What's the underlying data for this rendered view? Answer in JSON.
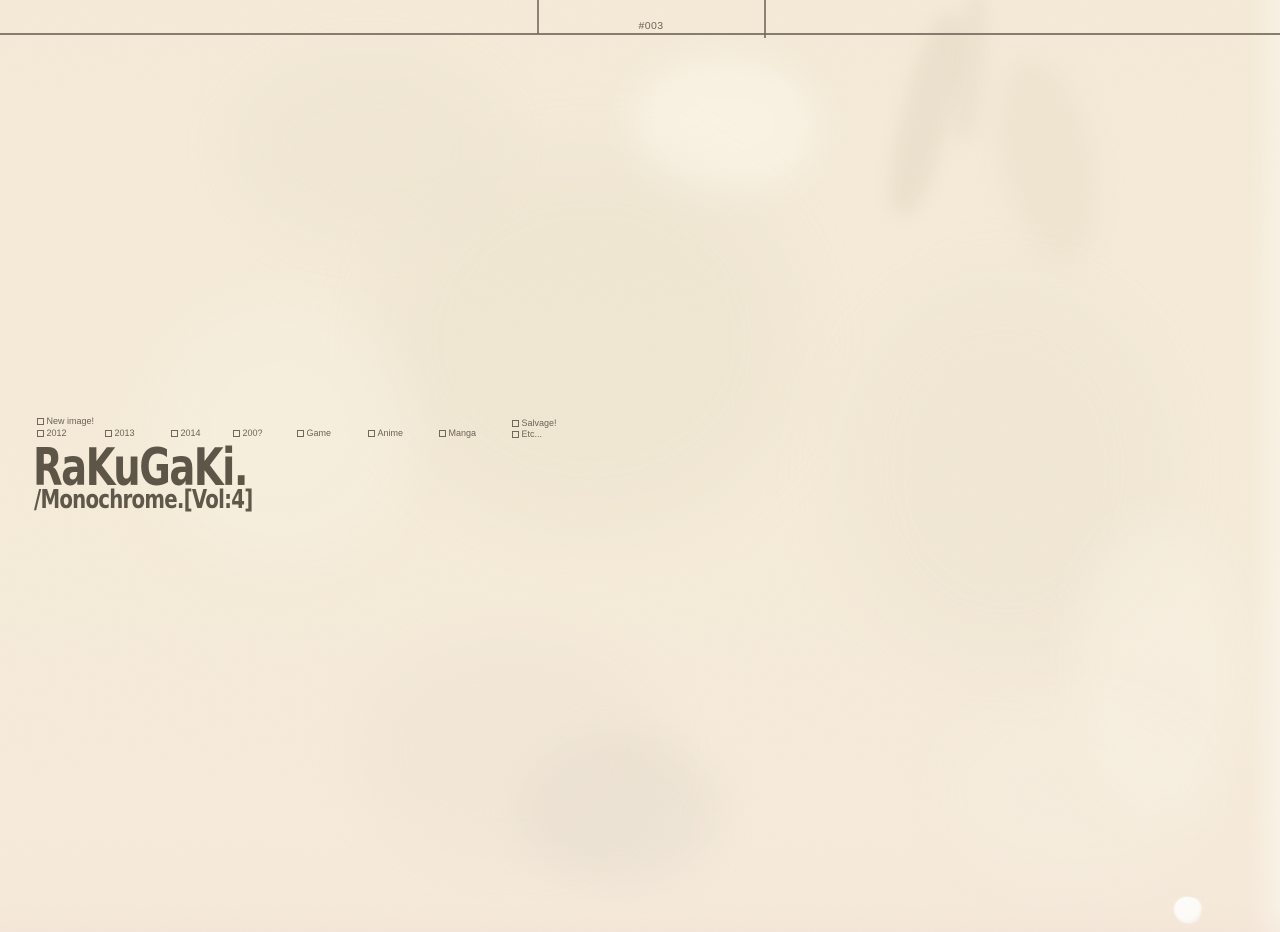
{
  "header": {
    "page_number": "#003"
  },
  "filters": {
    "line1": [
      {
        "label": "New image!"
      },
      {
        "label": "Salvage!"
      }
    ],
    "line2": [
      {
        "label": "2012"
      },
      {
        "label": "2013"
      },
      {
        "label": "2014"
      },
      {
        "label": "200?"
      },
      {
        "label": "Game"
      },
      {
        "label": "Anime"
      },
      {
        "label": "Manga"
      },
      {
        "label": "Etc..."
      }
    ]
  },
  "titleblock": {
    "title": "RaKuGaKi.",
    "subtitle": "/Monochrome.[Vol:4]"
  },
  "icons": {
    "checkbox_empty": "□"
  },
  "colors": {
    "paper": "#f6ecd9",
    "title_ink": "#5b5345",
    "label_ink": "#6b6254",
    "rule": "#71685b",
    "blemish": "#fefdf9"
  }
}
